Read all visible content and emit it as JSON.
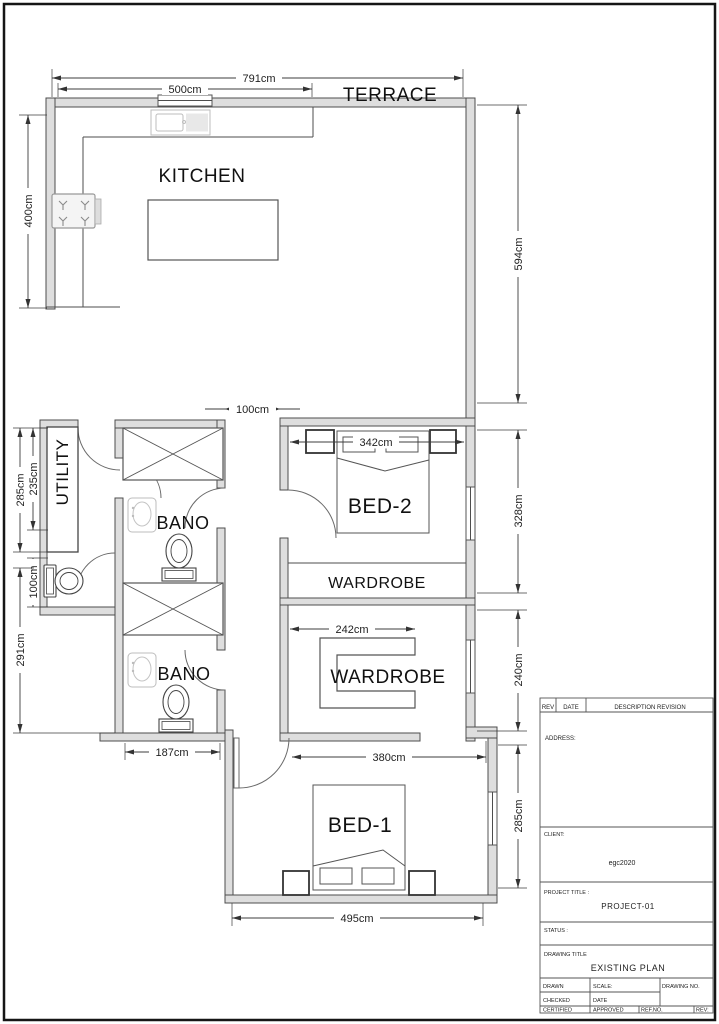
{
  "plan": {
    "rooms": {
      "terrace": "TERRACE",
      "kitchen": "KITCHEN",
      "utility": "UTILITY",
      "bano_upper": "BANO",
      "bano_lower": "BANO",
      "bed2": "BED-2",
      "wardrobe_bed2": "WARDROBE",
      "wardrobe_walkin": "WARDROBE",
      "bed1": "BED-1"
    },
    "dims": {
      "overall_top": "791cm",
      "kitchen_top": "500cm",
      "kitchen_left": "400cm",
      "terrace_right": "594cm",
      "corridor": "100cm",
      "utility_outer": "285cm",
      "utility_inner": "235cm",
      "bed2_width": "342cm",
      "bed2_right": "328cm",
      "wc_left": "100cm",
      "lower_left": "291cm",
      "wardrobe_width": "242cm",
      "wardrobe_right": "240cm",
      "bano_width": "187cm",
      "bed1_top": "380cm",
      "bed1_right": "285cm",
      "bed1_bottom": "495cm"
    }
  },
  "titleblock": {
    "rev_header": {
      "rev": "REV",
      "date": "DATE",
      "description": "DESCRIPTION REVISION"
    },
    "address_label": "ADDRESS:",
    "client_label": "CLIENT:",
    "client_value": "egc2020",
    "project_label": "PROJECT TITLE :",
    "project_value": "PROJECT-01",
    "status_label": "STATUS :",
    "drawing_title_label": "DRAWING TITLE",
    "drawing_title_value": "EXISTING PLAN",
    "bottom": {
      "drawn": "DRAWN",
      "scale": "SCALE:",
      "drawing_no": "DRAWING NO.",
      "checked": "CHECKED",
      "date": "DATE",
      "certified": "CERTIFIED",
      "approved": "APPROVED",
      "ref_no": "REF.NO.",
      "rev": "REV:"
    }
  }
}
